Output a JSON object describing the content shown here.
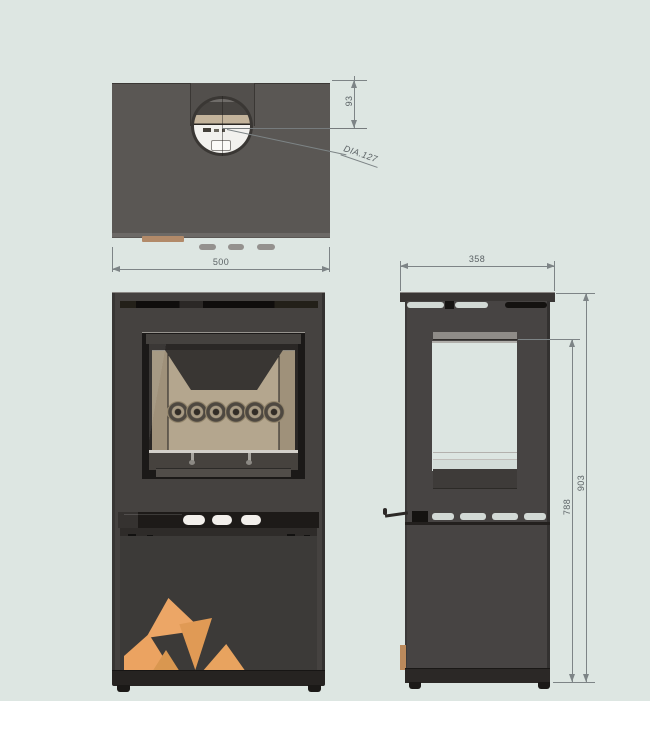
{
  "dims": {
    "top_width": "500",
    "flue_offset": "93",
    "flue_diameter": "DIA.127",
    "depth": "358",
    "inner_height": "788",
    "overall_height": "903"
  },
  "features": {
    "air_hole_count": 6,
    "front_vent_count": 3,
    "side_vent_count": 4,
    "log_count": 5
  },
  "colors": {
    "background": "#dde6e2",
    "page_margin": "#ffffff",
    "stove_body": "#454240",
    "top_view_surface": "#5a5754",
    "door_frame": "#1b1918",
    "firebrick": "#b4a68e",
    "baffle": "#393633",
    "logs": "#e8a361",
    "flue_band": "#c3b39b",
    "dimension_lines": "#7d8486",
    "dimension_text": "#5b6265"
  }
}
